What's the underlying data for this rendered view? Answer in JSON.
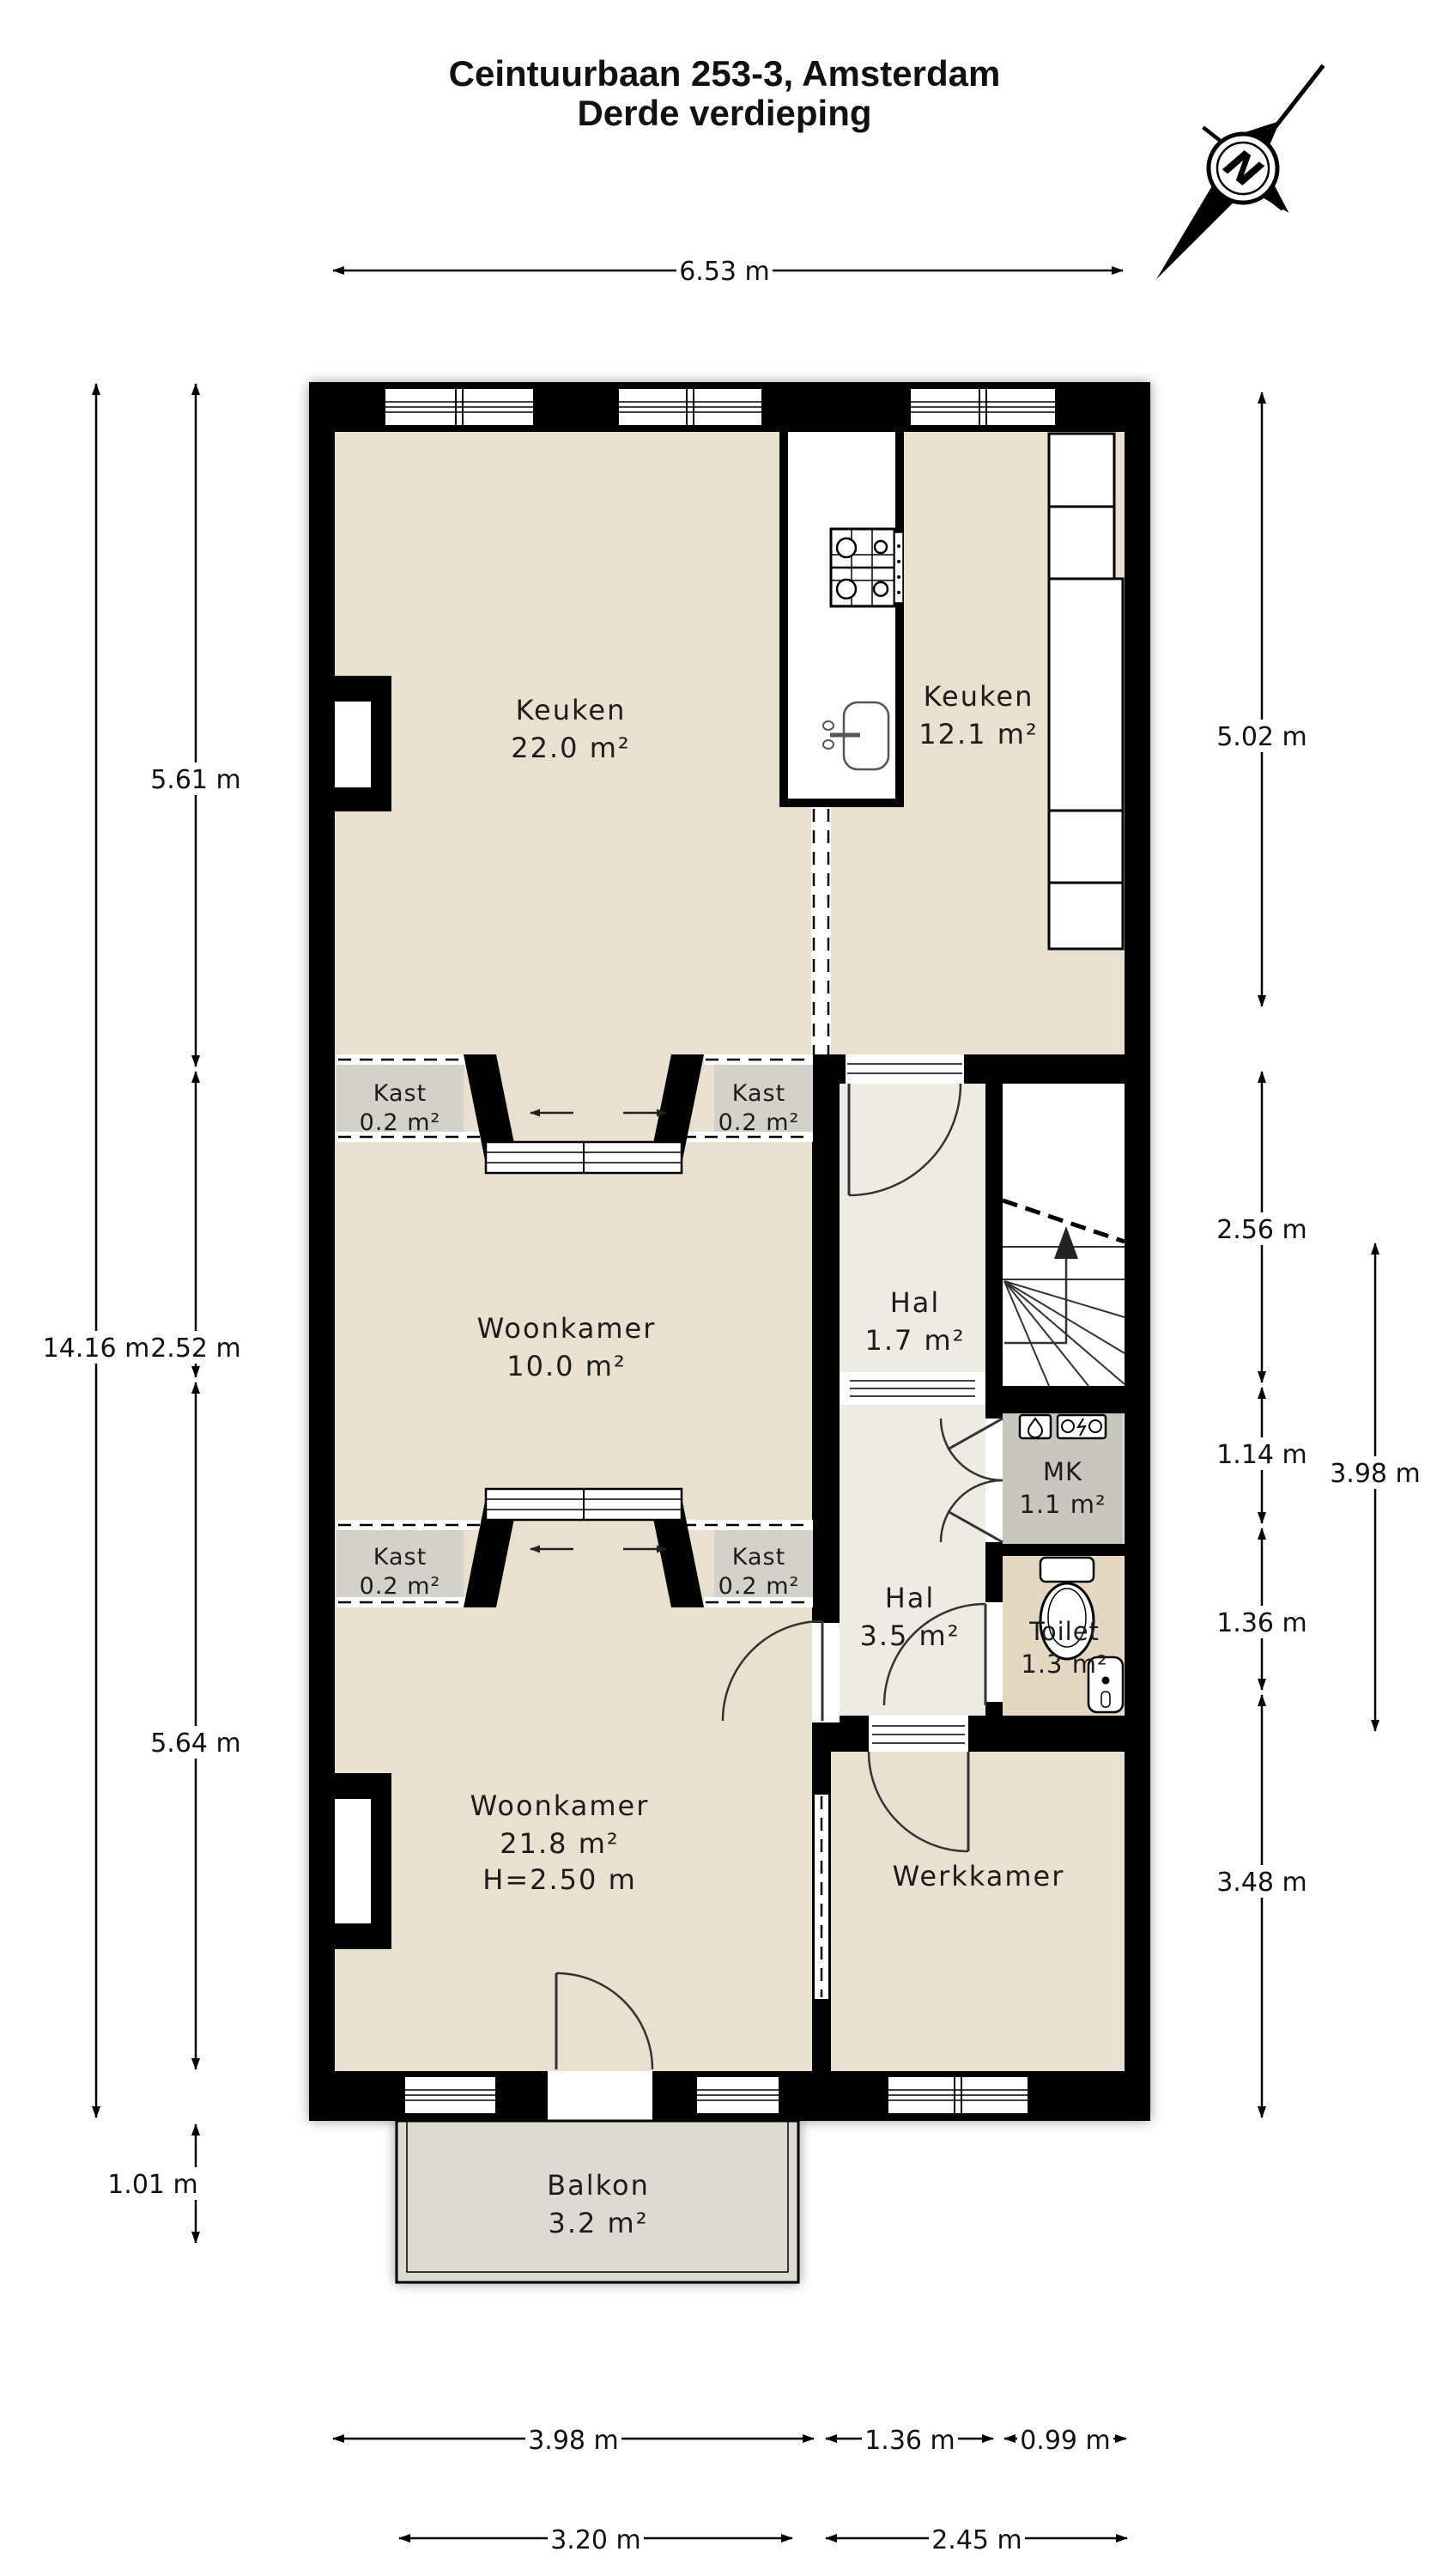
{
  "title": {
    "line1": "Ceintuurbaan 253-3, Amsterdam",
    "line2": "Derde verdieping"
  },
  "compass": {
    "north_label": "N"
  },
  "rooms": {
    "keuken_left": {
      "name": "Keuken",
      "area": "22.0 m²"
    },
    "keuken_right": {
      "name": "Keuken",
      "area": "12.1 m²"
    },
    "kast_boven_links": {
      "name": "Kast",
      "area": "0.2 m²"
    },
    "kast_boven_rechts": {
      "name": "Kast",
      "area": "0.2 m²"
    },
    "woonkamer_midden": {
      "name": "Woonkamer",
      "area": "10.0 m²"
    },
    "hal_boven": {
      "name": "Hal",
      "area": "1.7 m²"
    },
    "kast_onder_links": {
      "name": "Kast",
      "area": "0.2 m²"
    },
    "kast_onder_rechts": {
      "name": "Kast",
      "area": "0.2 m²"
    },
    "hal_onder": {
      "name": "Hal",
      "area": "3.5 m²"
    },
    "meterkast": {
      "name": "MK",
      "area": "1.1 m²"
    },
    "toilet": {
      "name": "Toilet",
      "area": "1.3 m²"
    },
    "woonkamer_groot": {
      "name": "Woonkamer",
      "area": "21.8 m²",
      "ceiling_height": "H=2.50 m"
    },
    "werkkamer": {
      "name": "Werkkamer"
    },
    "balkon": {
      "name": "Balkon",
      "area": "3.2 m²"
    }
  },
  "dimensions": {
    "top_width": "6.53 m",
    "left_total": "14.16 m",
    "left_keuken": "5.61 m",
    "left_woonkamer_midden": "2.52 m",
    "left_woonkamer_groot": "5.64 m",
    "left_balkon": "1.01 m",
    "right_keuken": "5.02 m",
    "right_trap": "2.56 m",
    "right_meterkast": "1.14 m",
    "right_toilet": "1.36 m",
    "right_werkkamer": "3.48 m",
    "right_binnen_totaal": "3.98 m",
    "bottom_woonkamer": "3.98 m",
    "bottom_hal": "1.36 m",
    "bottom_rechts": "0.99 m",
    "bottom_balkon": "3.20 m",
    "bottom_werkkamer": "2.45 m"
  },
  "colors": {
    "wall": "#000000",
    "floor_beige": "#e9e0d0",
    "floor_warm": "#e5d8c3",
    "hall_floor": "#edece4",
    "closet_gray": "#d2d2ca",
    "meterkast_gray": "#c7c7c0",
    "balcony_gray": "#dbdbd4",
    "stair_white": "#ffffff",
    "text": "#1c1c1c",
    "background": "#ffffff"
  }
}
